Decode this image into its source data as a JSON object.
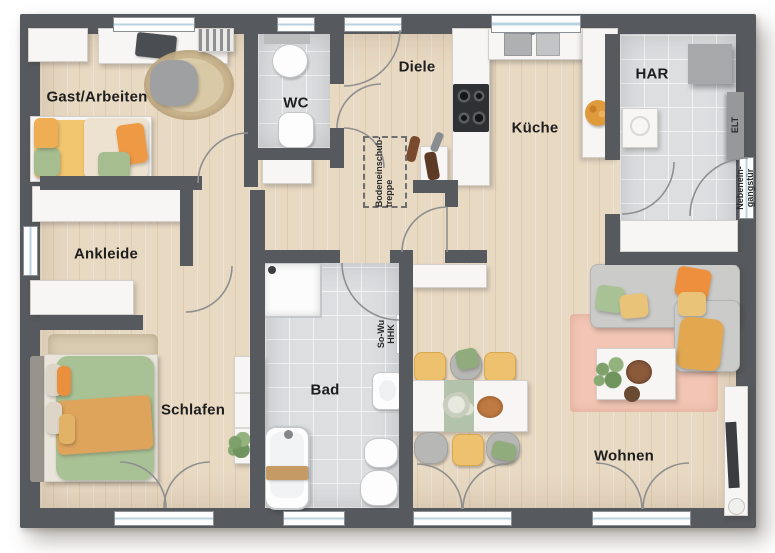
{
  "plan_type": "floor-plan",
  "rooms": [
    {
      "id": "gast-arbeiten",
      "label": "Gast/Arbeiten"
    },
    {
      "id": "wc",
      "label": "WC"
    },
    {
      "id": "diele",
      "label": "Diele"
    },
    {
      "id": "kueche",
      "label": "Küche"
    },
    {
      "id": "har",
      "label": "HAR"
    },
    {
      "id": "ankleide",
      "label": "Ankleide"
    },
    {
      "id": "schlafen",
      "label": "Schlafen"
    },
    {
      "id": "bad",
      "label": "Bad"
    },
    {
      "id": "wohnen",
      "label": "Wohnen"
    }
  ],
  "annotations": {
    "attic_stairs": "Bodeneinschub-\ntreppe",
    "heater": "So-Wu\nHHK",
    "electrical": "ELT",
    "side_entrance": "Nebenein-\ngangstür"
  },
  "colors": {
    "wall": "#56595d",
    "wood_floor": "#e8d9c3",
    "tile_floor": "#dcdee0",
    "accent_orange": "#ed8f3d",
    "accent_yellow": "#eec16e",
    "accent_green": "#a9c295",
    "rug_pink": "#f2c5b4",
    "window_glass": "#b9d2e0"
  }
}
